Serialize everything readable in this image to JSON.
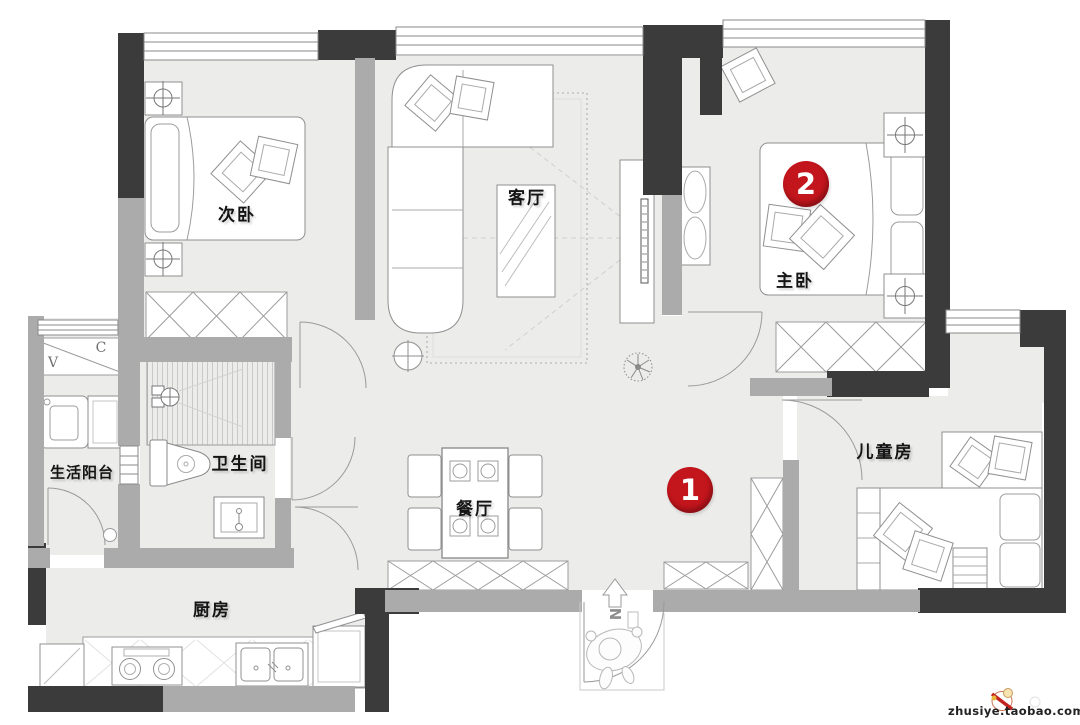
{
  "plan_title": "apartment-floor-plan",
  "colors": {
    "wall_dark": "#3b3b3b",
    "wall_gray": "#ababab",
    "floor": "#ecedeb",
    "furniture_line": "#8f8f8f",
    "marker_red": "#c3151c"
  },
  "rooms": {
    "bedroom2": {
      "label": "次卧"
    },
    "living": {
      "label": "客厅"
    },
    "master": {
      "label": "主卧"
    },
    "balcony": {
      "label": "生活阳台"
    },
    "bathroom": {
      "label": "卫生间"
    },
    "dining": {
      "label": "餐厅"
    },
    "kitchen": {
      "label": "厨房"
    },
    "kids": {
      "label": "儿童房"
    }
  },
  "markers": [
    {
      "number": "1"
    },
    {
      "number": "2"
    }
  ],
  "compass": {
    "label": "N"
  },
  "balcony_cabinet": {
    "left": "V",
    "right": "C"
  },
  "watermark": {
    "text": "zhusiye.taobao.com"
  }
}
